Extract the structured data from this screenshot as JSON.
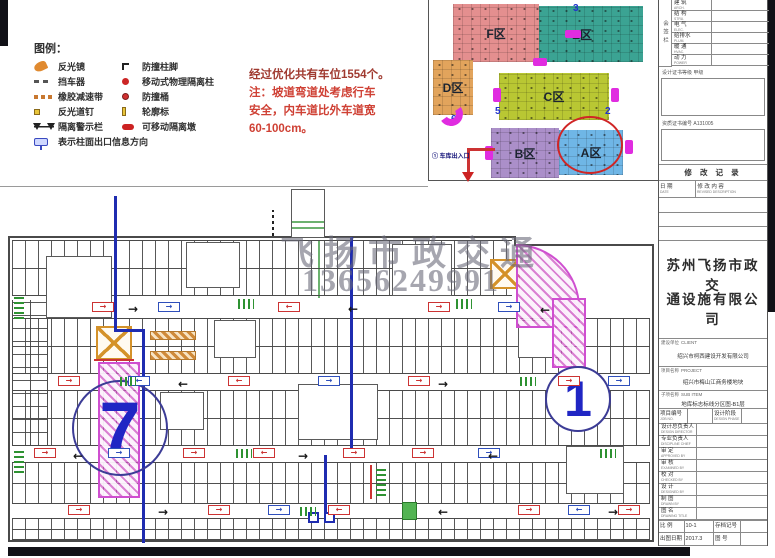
{
  "legend": {
    "title": "图例：",
    "rows": [
      {
        "left": {
          "icon": "mirror-icon",
          "label": "反光镜"
        },
        "right": {
          "icon": "corner-guard-icon",
          "label": "防撞柱脚"
        }
      },
      {
        "left": {
          "icon": "wheel-stop-icon",
          "label": "挡车器"
        },
        "right": {
          "icon": "isolation-post-icon",
          "label": "移动式物理隔离柱"
        }
      },
      {
        "left": {
          "icon": "speed-bump-icon",
          "label": "橡胶减速带"
        },
        "right": {
          "icon": "crash-barrel-icon",
          "label": "防撞桶"
        }
      },
      {
        "left": {
          "icon": "road-stud-icon",
          "label": "反光道钉"
        },
        "right": {
          "icon": "profile-marker-icon",
          "label": "轮廓标"
        }
      },
      {
        "left": {
          "icon": "warning-rail-icon",
          "label": "隔离警示栏"
        },
        "right": {
          "icon": "movable-pier-icon",
          "label": "可移动隔离墩"
        }
      }
    ],
    "footer": {
      "icon": "exit-info-icon",
      "label": "表示柱面出口信息方向"
    }
  },
  "notes": {
    "line1": "经过优化共有车位1554个。",
    "line2": "注：坡道弯道处考虑行车",
    "line3": "安全，内车道比外车道宽",
    "line4": "60-100cm。"
  },
  "keymap": {
    "zones": [
      {
        "label": "F区",
        "color": "#e48f8f"
      },
      {
        "label": "E区",
        "color": "#3ba393"
      },
      {
        "label": "D区",
        "color": "#e2a45c"
      },
      {
        "label": "C区",
        "color": "#b9c733"
      },
      {
        "label": "B区",
        "color": "#ab8fc9"
      },
      {
        "label": "A区",
        "color": "#6fb6e6"
      }
    ],
    "ramp_numbers": {
      "n3": "3",
      "n6": "6",
      "n5": "5",
      "n2": "2"
    },
    "entrance_label": "① 车库出入口",
    "arrow_color": "#cc2222",
    "connector_color": "#e02ce0"
  },
  "plan": {
    "left_ramp_number": "7",
    "right_ramp_number": "1",
    "watermark_line1": "飞扬市政交通",
    "watermark_line2": "13656249991"
  },
  "titleblock": {
    "signature_column": "会签栏",
    "signature_rows": [
      {
        "cn": "建 筑",
        "en": "ARCH."
      },
      {
        "cn": "结 构",
        "en": "STRU."
      },
      {
        "cn": "电 气",
        "en": "ELEC."
      },
      {
        "cn": "给排水",
        "en": "PLUM."
      },
      {
        "cn": "暖 通",
        "en": "HVAC."
      },
      {
        "cn": "动 力",
        "en": "POWER"
      }
    ],
    "cert_grade_label": "设计证书等级  甲级",
    "cert_no_label": "资质证书编号  A131005",
    "revision_title": "修 改 记 录",
    "rev_date_cn": "日 期",
    "rev_date_en": "DATE",
    "rev_content_cn": "修 改 内 容",
    "rev_content_en": "REVISED DESCRIPTION",
    "company_line1": "苏州飞扬市政交",
    "company_line2": "通设施有限公司",
    "client_label": "建设单位",
    "client_en": "CLIENT",
    "client_value": "绍兴市柯西建设开发有限公司",
    "project_label": "项目名称",
    "project_en": "PROJECT",
    "project_value": "绍兴市梅山江商务楼地块",
    "subitem_label": "子项名称",
    "subitem_en": "SUB ITEM",
    "subitem_value": "地库标志标线分区图-B1层",
    "field_rows": [
      {
        "label": "项目编号",
        "en": "JOB NO.",
        "label2": "设计阶段",
        "en2": "DESIGN PHASE"
      },
      {
        "label": "设计总负责人",
        "en": "DESIGN DIRECTOR"
      },
      {
        "label": "专业负责人",
        "en": "DISCIPLINE CHIEF"
      },
      {
        "label": "审 定",
        "en": "APPROVED BY"
      },
      {
        "label": "审 核",
        "en": "EXAMINED BY"
      },
      {
        "label": "校 对",
        "en": "CHECKED BY"
      },
      {
        "label": "设 计",
        "en": "DESIGNED BY"
      },
      {
        "label": "制 图",
        "en": "DRAWN BY"
      }
    ],
    "drawing_title_label": "图 名",
    "drawing_title_en": "DRAWING TITLE",
    "scale_label": "比 例",
    "scale_value": "10-1",
    "date_label": "出图日期",
    "date_value": "2017.3",
    "archive_label": "存档记号",
    "sheet_label": "图 号"
  },
  "colors": {
    "note_red": "#cf4034",
    "plan_blue": "#1f2cb0",
    "ramp_pink": "#cf4fd0",
    "sign_red": "#cc3333",
    "sign_blue": "#2f4fbb",
    "green": "#2e9232",
    "shaft_orange": "#d4922a"
  }
}
